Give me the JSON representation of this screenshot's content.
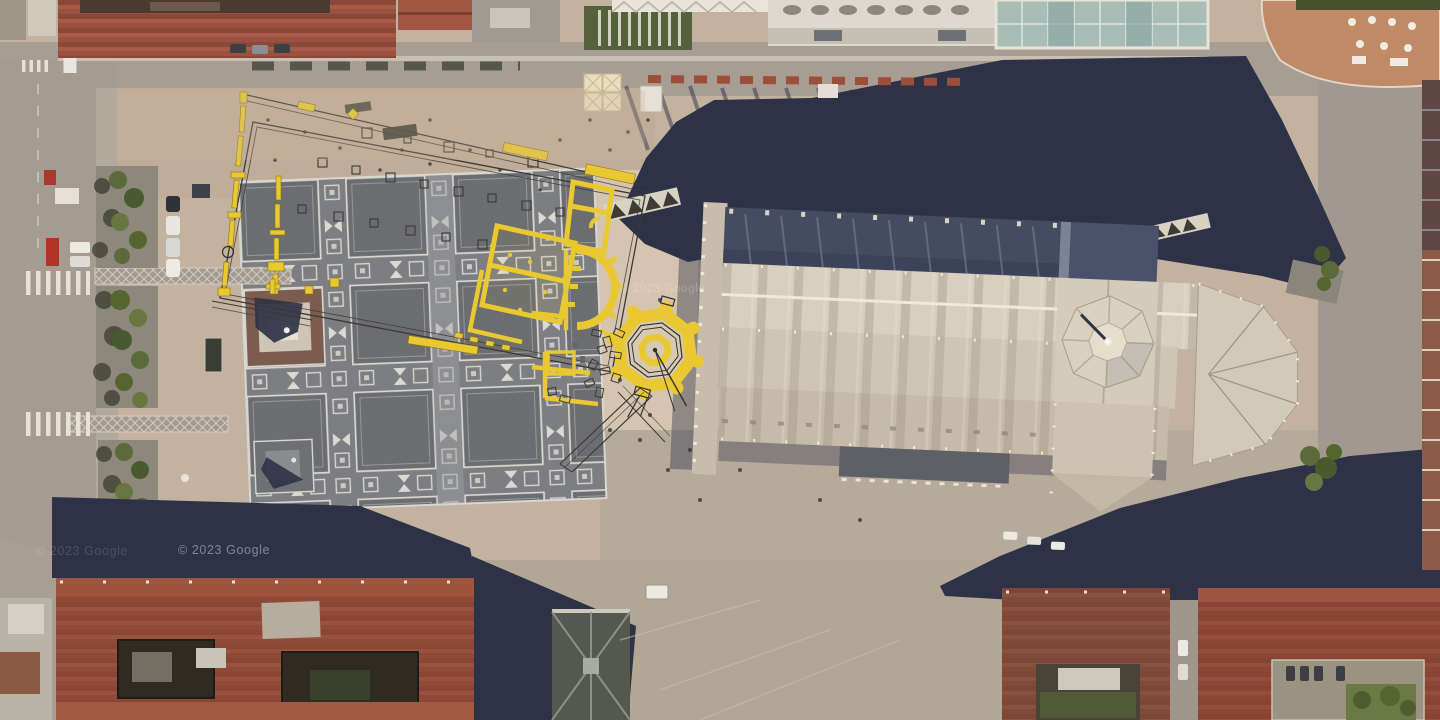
{
  "map": {
    "view": "satellite-aerial",
    "location_hint": "",
    "attribution": {
      "text": "© 2023 Google"
    }
  },
  "colors": {
    "pavement": "#c3b2a0",
    "piazza_upper": "#bfab97",
    "piazza_grid_square": "#6b6d71",
    "piazza_grid_band": "#7c7e81",
    "grid_lines": "#d8d6d0",
    "hard_shadow": "#2d3247",
    "cathedral_roof_lit": "#d8cfbe",
    "cathedral_roof_shade": "#454c61",
    "overlay_yellow": "#e9c832",
    "overlay_plan_line": "#3a3933",
    "red_tile_roof": "#9a5140",
    "brown_roof": "#8c4636",
    "tree_green": "#5a6a3a",
    "glass_roof": "#a7bdb6",
    "terrace_terracotta": "#c08a66",
    "street": "#a79d92"
  }
}
